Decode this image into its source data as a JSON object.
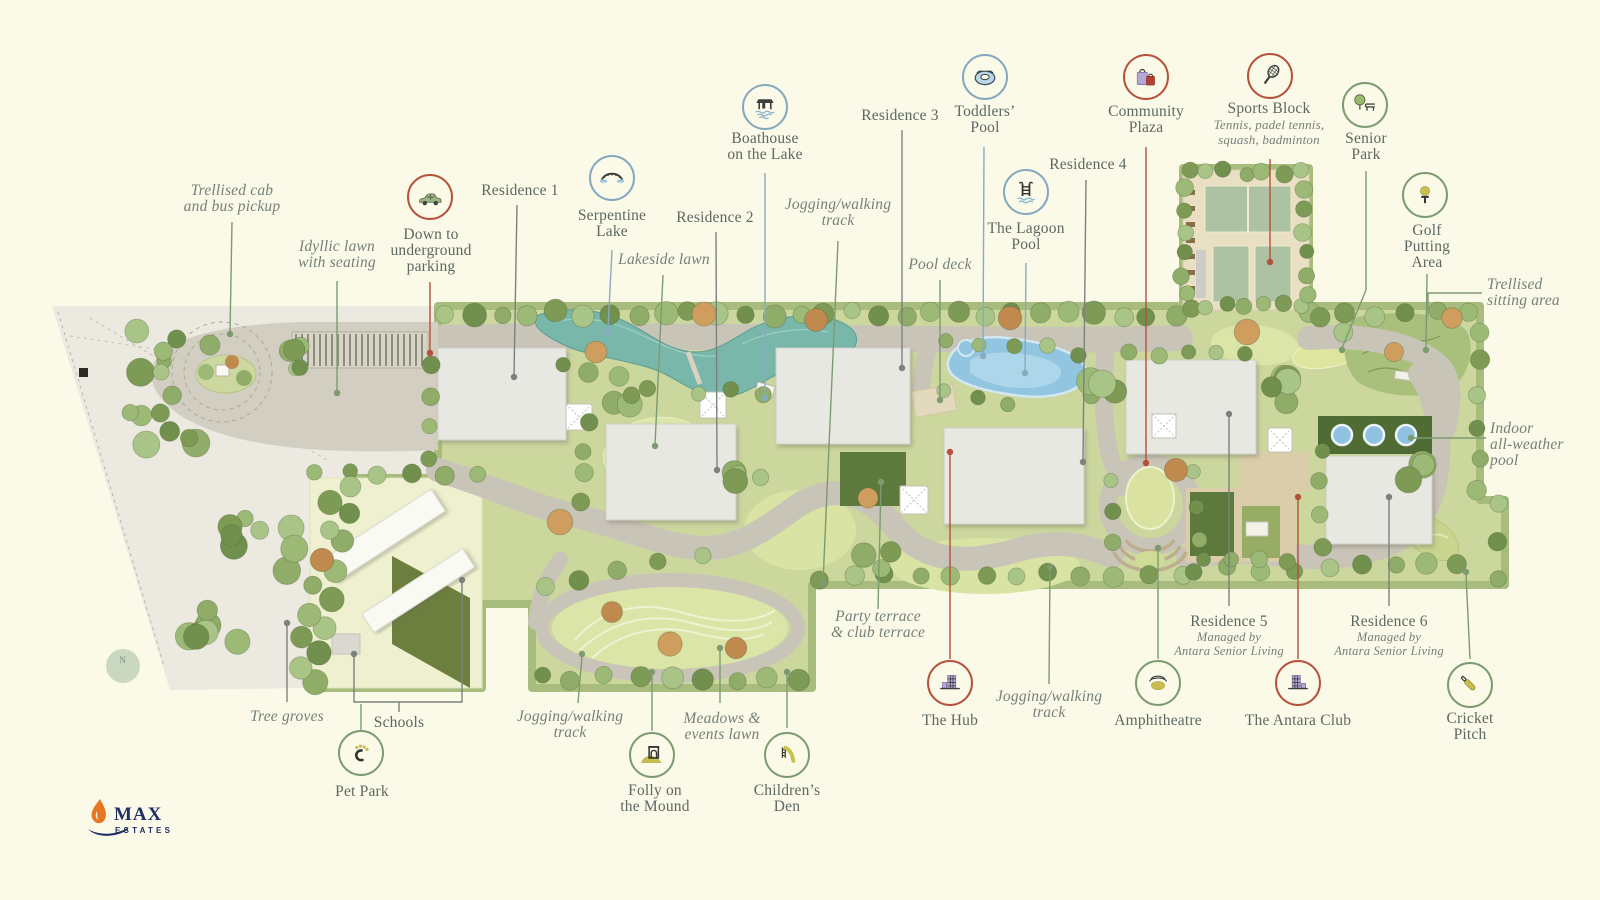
{
  "branding": {
    "logo_text": "MAX",
    "logo_sub": "ESTATES"
  },
  "compass": {
    "north_label": "N"
  },
  "colors": {
    "background": "#fbfae9",
    "accent_red": "#b5503a",
    "accent_green": "#7d9b70",
    "accent_blue": "#84a9be",
    "label_gray": "#5d6862",
    "water_teal": "#79b7ab",
    "pool_blue": "#92c6e0"
  },
  "icons": {
    "down_parking": "car-icon",
    "serpentine_lake": "bridge-icon",
    "boathouse": "boathouse-icon",
    "toddlers_pool": "swim-ring-icon",
    "lagoon_pool": "pool-ladder-icon",
    "community_plaza": "shopping-bags-icon",
    "sports_block": "tennis-racket-icon",
    "senior_park": "tree-bench-icon",
    "golf": "golf-ball-tee-icon",
    "hub": "buildings-icon",
    "amphitheatre": "amphitheatre-icon",
    "antara_club": "buildings-icon",
    "cricket": "cricket-bat-icon",
    "pet_park": "paw-icon",
    "folly": "folly-arch-icon",
    "childrens_den": "slide-icon"
  },
  "callouts": {
    "trellised_cab": {
      "lines": [
        "Trellised cab",
        "and bus pickup"
      ]
    },
    "idyllic_lawn": {
      "lines": [
        "Idyllic lawn",
        "with seating"
      ]
    },
    "down_parking": {
      "lines": [
        "Down to",
        "underground",
        "parking"
      ]
    },
    "residence1": {
      "label": "Residence 1"
    },
    "serpentine_lake": {
      "lines": [
        "Serpentine",
        "Lake"
      ]
    },
    "boathouse": {
      "lines": [
        "Boathouse",
        "on the Lake"
      ]
    },
    "residence2": {
      "label": "Residence 2"
    },
    "lakeside_lawn": {
      "label": "Lakeside lawn"
    },
    "jogging_top": {
      "lines": [
        "Jogging/walking",
        "track"
      ]
    },
    "residence3": {
      "label": "Residence 3"
    },
    "toddlers_pool": {
      "lines": [
        "Toddlers’",
        "Pool"
      ]
    },
    "pool_deck": {
      "label": "Pool deck"
    },
    "lagoon_pool": {
      "lines": [
        "The Lagoon",
        "Pool"
      ]
    },
    "residence4": {
      "label": "Residence 4"
    },
    "community_plaza": {
      "lines": [
        "Community",
        "Plaza"
      ]
    },
    "sports_block": {
      "label": "Sports Block",
      "sub_lines": [
        "Tennis, padel tennis,",
        "squash, badminton"
      ]
    },
    "senior_park": {
      "lines": [
        "Senior",
        "Park"
      ]
    },
    "golf": {
      "lines": [
        "Golf",
        "Putting",
        "Area"
      ]
    },
    "trellised_sitting": {
      "lines": [
        "Trellised",
        "sitting area"
      ]
    },
    "indoor_pool": {
      "lines": [
        "Indoor",
        "all-weather",
        "pool"
      ]
    },
    "residence5": {
      "label": "Residence 5",
      "sub_lines": [
        "Managed by",
        "Antara Senior Living"
      ]
    },
    "residence6": {
      "label": "Residence 6",
      "sub_lines": [
        "Managed by",
        "Antara Senior Living"
      ]
    },
    "hub": {
      "label": "The Hub"
    },
    "jogging_mid": {
      "lines": [
        "Jogging/walking",
        "track"
      ]
    },
    "amphitheatre": {
      "label": "Amphitheatre"
    },
    "antara_club": {
      "label": "The Antara Club"
    },
    "cricket": {
      "lines": [
        "Cricket",
        "Pitch"
      ]
    },
    "party_terrace": {
      "lines": [
        "Party terrace",
        "& club terrace"
      ]
    },
    "meadows": {
      "lines": [
        "Meadows &",
        "events lawn"
      ]
    },
    "jogging_left": {
      "lines": [
        "Jogging/walking",
        "track"
      ]
    },
    "folly": {
      "lines": [
        "Folly on",
        "the Mound"
      ]
    },
    "childrens_den": {
      "lines": [
        "Children’s",
        "Den"
      ]
    },
    "pet_park": {
      "label": "Pet Park"
    },
    "schools": {
      "label": "Schools"
    },
    "tree_groves": {
      "label": "Tree groves"
    }
  }
}
